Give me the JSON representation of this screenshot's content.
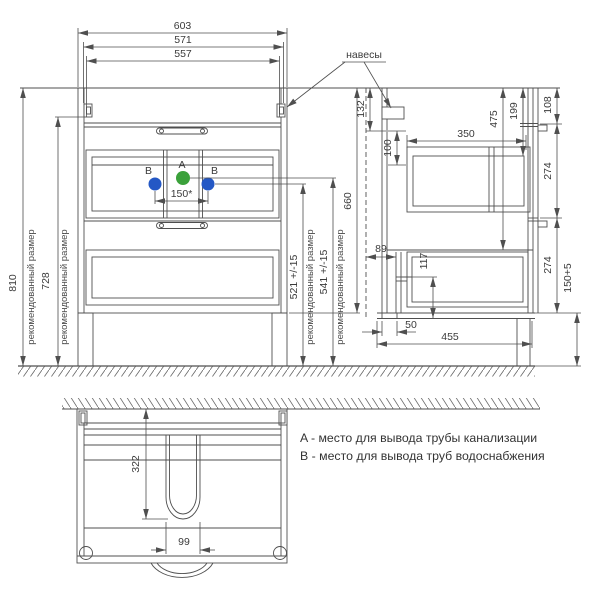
{
  "drawing": {
    "legend": {
      "sewer": "A - место для вывода трубы канализации",
      "water": "B - место для вывода труб водоснабжения"
    },
    "labels": {
      "hangers": "навесы",
      "recommended_size": "рекомендованный размер",
      "point_a": "A",
      "point_b": "B"
    },
    "front_view": {
      "width_total": "603",
      "width_hinges": "571",
      "width_drawer": "557",
      "height_recommended": "810",
      "height_hinge_recommended": "728",
      "pipe_spacing": "150*",
      "water_outlet_height": "521 +/-15",
      "sewer_outlet_height": "541 +/-15",
      "body_height": "660"
    },
    "side_view": {
      "hinge_top_offset": "132",
      "hinge_hole_spacing": "100",
      "drawer_depth": "350",
      "inner_height": "475",
      "top_section": "199",
      "top_panel_height": "108",
      "upper_drawer_front": "274",
      "lower_drawer_front": "274",
      "legs_height": "150+5",
      "wall_recess_depth": "89",
      "recess_height": "117",
      "back_offset": "50",
      "body_depth": "455"
    },
    "top_view": {
      "cutout_depth": "322",
      "cutout_width": "99"
    },
    "colors": {
      "sewer_marker": "#3ba13b",
      "water_marker": "#2458c5"
    }
  }
}
